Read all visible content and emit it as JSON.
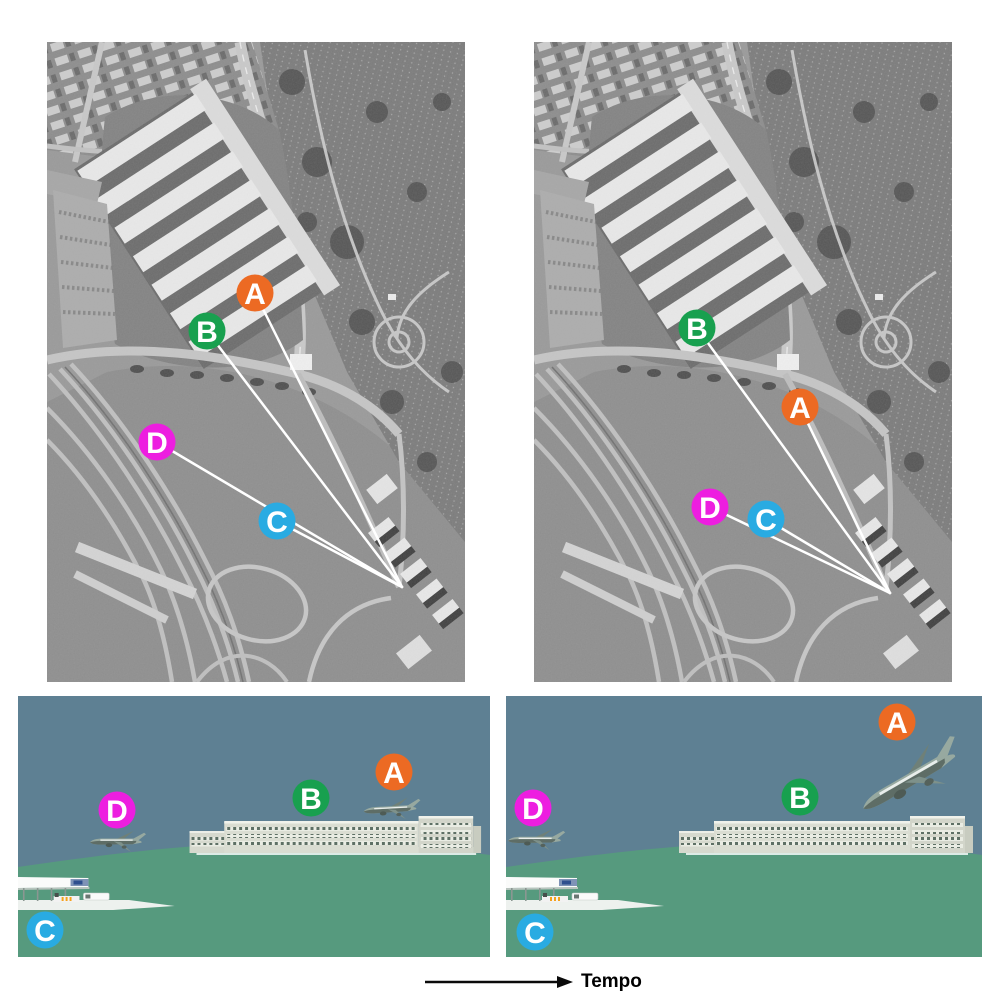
{
  "palette": {
    "background": "#ffffff",
    "sight_line": "#ffffff",
    "marker_text": "#ffffff",
    "sky": "#5E8093",
    "ground": "#569A7E",
    "arrow": "#0a0a0a"
  },
  "markers": {
    "A": {
      "label": "A",
      "color": "#EC6A23"
    },
    "B": {
      "label": "B",
      "color": "#18A04F"
    },
    "C": {
      "label": "C",
      "color": "#29ABE2"
    },
    "D": {
      "label": "D",
      "color": "#ED1EE0"
    }
  },
  "timeline": {
    "label": "Tempo"
  },
  "panels": [
    {
      "id": "aerial-t1",
      "view": "aerial",
      "time": "t1",
      "camera": {
        "x": 355,
        "y": 545
      },
      "markers": [
        {
          "label": "A",
          "x": 208,
          "y": 251
        },
        {
          "label": "B",
          "x": 160,
          "y": 289
        },
        {
          "label": "D",
          "x": 110,
          "y": 400
        },
        {
          "label": "C",
          "x": 230,
          "y": 479
        }
      ]
    },
    {
      "id": "aerial-t2",
      "view": "aerial",
      "time": "t2",
      "camera": {
        "x": 356,
        "y": 551
      },
      "markers": [
        {
          "label": "B",
          "x": 163,
          "y": 286
        },
        {
          "label": "A",
          "x": 266,
          "y": 365
        },
        {
          "label": "D",
          "x": 176,
          "y": 465
        },
        {
          "label": "C",
          "x": 232,
          "y": 477
        }
      ]
    },
    {
      "id": "scene-t1",
      "view": "profile",
      "time": "t1",
      "planes": [
        {
          "near": "A",
          "x": 344,
          "y": 102,
          "scale": 0.97,
          "rotate": -3
        },
        {
          "near": "D",
          "x": 71,
          "y": 133,
          "scale": 0.95,
          "rotate": 0
        }
      ],
      "markers": [
        {
          "label": "A",
          "x": 376,
          "y": 76
        },
        {
          "label": "B",
          "x": 293,
          "y": 102
        },
        {
          "label": "D",
          "x": 99,
          "y": 114
        },
        {
          "label": "C",
          "x": 27,
          "y": 234
        }
      ]
    },
    {
      "id": "scene-t2",
      "view": "profile",
      "time": "t2",
      "planes": [
        {
          "near": "A",
          "x": 342,
          "y": 90,
          "scale": 1.95,
          "rotate": -30
        },
        {
          "near": "D",
          "x": 1,
          "y": 131,
          "scale": 0.97,
          "rotate": 0
        }
      ],
      "markers": [
        {
          "label": "A",
          "x": 391,
          "y": 26
        },
        {
          "label": "B",
          "x": 294,
          "y": 101
        },
        {
          "label": "D",
          "x": 27,
          "y": 112
        },
        {
          "label": "C",
          "x": 29,
          "y": 236
        }
      ]
    }
  ]
}
